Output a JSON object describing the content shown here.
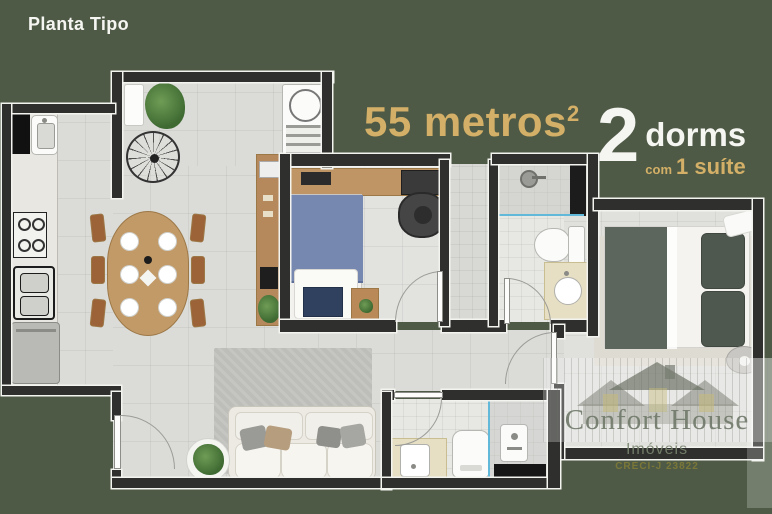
{
  "header": {
    "title": "Planta Tipo"
  },
  "labels": {
    "area": {
      "value": "55 metros",
      "sup": "2"
    },
    "dorms": {
      "number": "2",
      "word": "dorms",
      "com": "com",
      "suite": "1 suíte"
    }
  },
  "watermark": {
    "brand": "Confort House",
    "subtitle": "Imóveis",
    "creci": "CRECI-J 23822"
  },
  "colors": {
    "background": "#4e5a45",
    "accent_gold": "#d3af67",
    "text_white": "#f5f5f2",
    "wall": "#2f2f2d",
    "floor": "#dbdbd8",
    "water_line": "#62b8d8",
    "wood": "#c29a67",
    "bed_blue": "#7688b0",
    "suite_blanket_green": "#5c665c"
  }
}
